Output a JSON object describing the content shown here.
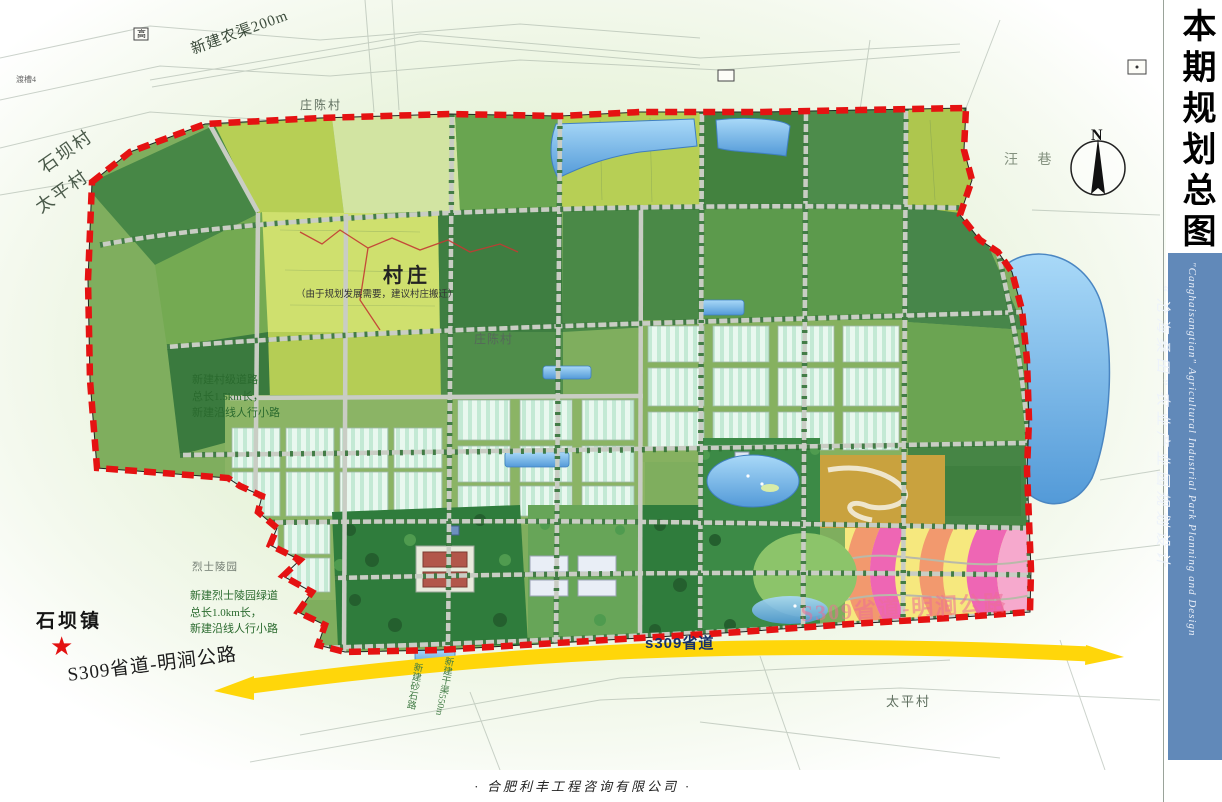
{
  "sidebar": {
    "title": "本期规划总图",
    "subtitle_cn": "“沧海桑田”农业产业园规划设计",
    "subtitle_en": "\"Canghaisangtian\" Agricultural Industrial Park Planning and Design",
    "strip_color": "#6189b9"
  },
  "footer": {
    "company": "·   合肥利丰工程咨询有限公司   ·"
  },
  "compass": {
    "north_label": "N"
  },
  "colors": {
    "boundary_red": "#e51212",
    "road_yellow": "#ffd60a",
    "water_blue": "#8fc4ee",
    "sidebar_blue": "#6189b9"
  },
  "map": {
    "star_icon": "★",
    "labels": [
      {
        "id": "canal-note",
        "text": "新建农渠200m"
      },
      {
        "id": "village-top",
        "text": "庄陈村"
      },
      {
        "id": "shiba-village",
        "text": "石坝村"
      },
      {
        "id": "taiping-village",
        "text": "太平村"
      },
      {
        "id": "cunzhuang",
        "text": "村庄"
      },
      {
        "id": "cunzhuang-note",
        "text": "（由于规划发展需要，建议村庄搬迁）"
      },
      {
        "id": "zhuangchen-mid",
        "text": "庄陈村"
      },
      {
        "id": "wangxiang",
        "text": "汪 巷"
      },
      {
        "id": "note-mid",
        "text": "新建村级道路\n总长1.5km长，\n新建沿线人行小路"
      },
      {
        "id": "lieshi-lingyuan",
        "text": "烈士陵园"
      },
      {
        "id": "note-south",
        "text": "新建烈士陵园绿道\n总长1.0km长，\n新建沿线人行小路"
      },
      {
        "id": "shibazhen",
        "text": "石坝镇"
      },
      {
        "id": "s309-main",
        "text": "S309省道-明涧公路"
      },
      {
        "id": "s309-band",
        "text": "s309省道"
      },
      {
        "id": "s309-faded",
        "text": "S309省道-明涧公路"
      },
      {
        "id": "taiping-bottom",
        "text": "太平村"
      },
      {
        "id": "v-label-1",
        "text": "新建砂石路"
      },
      {
        "id": "v-label-2",
        "text": "新建干渠550m"
      },
      {
        "id": "duchao",
        "text": "渡槽4"
      },
      {
        "id": "gao-marker",
        "text": "高"
      }
    ]
  }
}
